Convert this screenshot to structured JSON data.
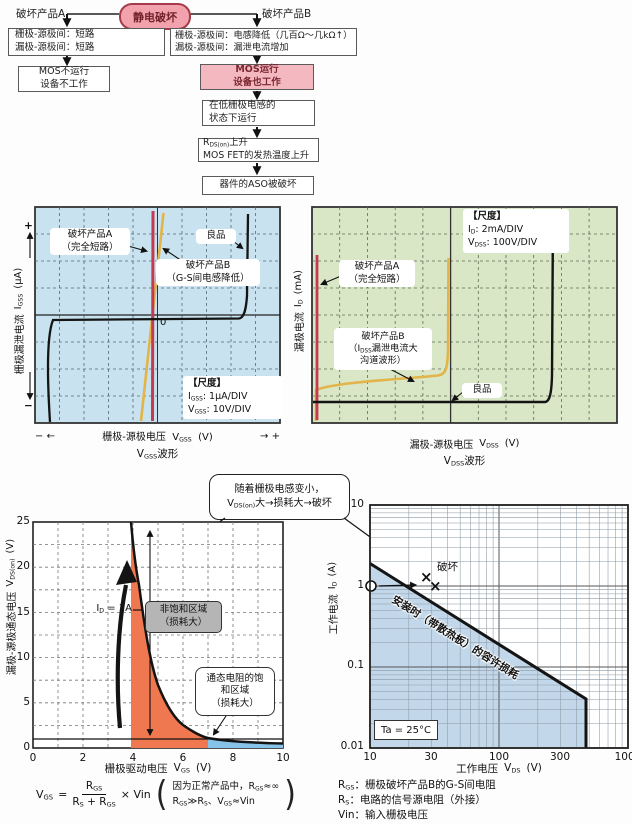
{
  "colors": {
    "osc_blue_bg": "#c9e2ef",
    "osc_green_bg": "#d9e7c6",
    "trace_red": "#c43a50",
    "trace_yellow": "#e2b44a",
    "trace_black": "#141414",
    "fill_orange": "#f07850",
    "fill_lightblue": "#85c3e8",
    "aso_fill_blue": "#c2d8ea",
    "pink_box": "#f4b9c0",
    "pink_root": "#f2a2ac"
  },
  "flow": {
    "root": "静电破坏",
    "a_title": "破坏产品A",
    "b_title": "破坏产品B",
    "a1_l1": "栅极-源极间：短路",
    "a1_l2": "漏极-源极间：短路",
    "a2_l1": "MOS不运行",
    "a2_l2": "设备不工作",
    "b1_l1": "栅极-源极间：电感降低（几百Ω～几kΩ↑）",
    "b1_l2": "漏极-源极间：漏泄电流增加",
    "b2_l1": "MOS运行",
    "b2_l2": "设备也工作",
    "b3_l1": "在低栅极电感的",
    "b3_l2": "状态下运行",
    "b4_l1_pre": "R",
    "b4_l1_sub": "DS(on)",
    "b4_l1_post": "上升",
    "b4_l2": "MOS FET的发热温度上升",
    "b5": "器件的ASO被破坏"
  },
  "gss": {
    "plus": "+",
    "minus": "−",
    "ylabel": "栅极漏泄电流",
    "ysym": "I",
    "ysub": "GSS",
    "yunit": "(μA)",
    "zero": "0",
    "labelA_l1": "破坏产品A",
    "labelA_l2": "（完全短路）",
    "labelB_l1": "破坏产品B",
    "labelB_l2": "（G-S间电感降低）",
    "good": "良品",
    "scale_title": "【尺度】",
    "s1_sym": "I",
    "s1_sub": "GSS",
    "s1_val": ": 1μA/DIV",
    "s2_sym": "V",
    "s2_sub": "GSS",
    "s2_val": ": 10V/DIV",
    "x_minus": "−",
    "x_arrow_l": "←",
    "xlabel": "栅极-源极电压",
    "xsym": "V",
    "xsub": "GSS",
    "xunit": "(V)",
    "x_arrow_r": "→",
    "x_plus": "+",
    "wave_pre": "V",
    "wave_sub": "GSS",
    "wave_post": "波形"
  },
  "dss": {
    "ylabel": "漏极电流",
    "ysym": "I",
    "ysub": "D",
    "yunit": "(mA)",
    "scale_title": "【尺度】",
    "s1_sym": "I",
    "s1_sub": "D",
    "s1_val": ": 2mA/DIV",
    "s2_sym": "V",
    "s2_sub": "DSS",
    "s2_val": ": 100V/DIV",
    "labelA_l1": "破坏产品A",
    "labelA_l2": "（完全短路）",
    "labelB_l1": "破坏产品B",
    "labelB_l2_pre": "（I",
    "labelB_l2_sub": "DSS",
    "labelB_l2_post": "漏泄电流大",
    "labelB_l3": "沟道波形）",
    "good": "良品",
    "xlabel": "漏极-源极电压",
    "xsym": "V",
    "xsub": "DSS",
    "xunit": "(V)",
    "wave_pre": "V",
    "wave_sub": "DSS",
    "wave_post": "波形"
  },
  "callout": {
    "l1": "随着栅极电感变小，",
    "l2_pre": "V",
    "l2_sub": "DS(on)",
    "l2_post": "大→损耗大→破坏"
  },
  "vgs": {
    "ylabel": "漏极-源极通态电压",
    "ysym": "V",
    "ysub": "DS(on)",
    "yunit": "(V)",
    "yticks": [
      "25",
      "20",
      "15",
      "10",
      "5",
      "0"
    ],
    "xticks": [
      "0",
      "2",
      "4",
      "6",
      "8",
      "10"
    ],
    "xlabel": "栅极驱动电压",
    "xsym": "V",
    "xsub": "GS",
    "xunit": "(V)",
    "id_pre": "I",
    "id_sub": "D",
    "id_post": " = 1A",
    "region1_l1": "非饱和区域",
    "region1_l2": "（损耗大）",
    "region2_l1": "通态电阻的饱",
    "region2_l2": "和区域",
    "region2_l3": "（损耗大）"
  },
  "aso": {
    "ylabel": "工作电流",
    "ysym": "I",
    "ysub": "D",
    "yunit": "(A)",
    "yticks": [
      "10",
      "1",
      "0.1",
      "0.01"
    ],
    "xticks": [
      "10",
      "30",
      "100",
      "300",
      "1000"
    ],
    "xlabel": "工作电压",
    "xsym": "V",
    "xsub": "DS",
    "xunit": "(V)",
    "destroy": "破坏",
    "x_mark": "×",
    "diag_label": "安装时（带散热板）的容许损耗",
    "ta": "Ta = 25°C"
  },
  "formula": {
    "lhs_sym": "V",
    "lhs_sub": "GS",
    "eq": "=",
    "num_sym": "R",
    "num_sub": "GS",
    "den1_sym": "R",
    "den1_sub": "S",
    "den_plus": " + ",
    "den2_sym": "R",
    "den2_sub": "GS",
    "times": "× Vin",
    "paren_l": "(",
    "paren_r": ")",
    "note_l1_pre": "因为正常产品中，R",
    "note_l1_sub": "GS",
    "note_l1_post": "≈∞",
    "note_l2_p1": "R",
    "note_l2_s1": "GS",
    "note_l2_p2": "≫R",
    "note_l2_s2": "S",
    "note_l2_p3": "、V",
    "note_l2_s3": "GS",
    "note_l2_p4": "≈Vin"
  },
  "defs": {
    "r1_sym": "R",
    "r1_sub": "GS",
    "r1_text": "：栅极破坏产品B的G-S间电阻",
    "r2_sym": "R",
    "r2_sub": "S",
    "r2_text": "：电路的信号源电阻（外接）",
    "r3_sym": "Vin",
    "r3_text": "：输入栅极电压"
  },
  "chart_data": [
    {
      "type": "line",
      "title": "VGSS波形 (oscilloscope)",
      "xlabel": "栅极-源极电压 VGSS (V)",
      "ylabel": "栅极漏泄电流 IGSS (μA)",
      "scale": {
        "IGSS": "1μA/DIV",
        "VGSS": "10V/DIV"
      },
      "grid": "10x8 dashed divisions",
      "series": [
        {
          "name": "破坏产品A（完全短路）",
          "shape": "vertical line through 0V (dead short)"
        },
        {
          "name": "破坏产品B（G-S间电感降低）",
          "shape": "slightly tilted line through 0V (low resistance)"
        },
        {
          "name": "良品",
          "shape": "flat ~0μA across sweep with sharp breakdown rise at both sweep ends"
        }
      ]
    },
    {
      "type": "line",
      "title": "VDSS波形 (oscilloscope)",
      "xlabel": "漏极-源极电压 VDSS (V)",
      "ylabel": "漏极电流 ID (mA)",
      "scale": {
        "ID": "2mA/DIV",
        "VDSS": "100V/DIV"
      },
      "grid": "11x8 dashed divisions",
      "series": [
        {
          "name": "破坏产品A（完全短路）",
          "shape": "vertical line at ~0V"
        },
        {
          "name": "破坏产品B（IDSS漏泄电流大，沟道波形）",
          "shape": "elevated leakage rising slowly, early breakdown rise at ~480V-div"
        },
        {
          "name": "良品",
          "shape": "flat ~0mA then sharp breakdown rise near right end (~850V-div)"
        }
      ]
    },
    {
      "type": "line",
      "title": "VDS(on) vs VGS at ID = 1A",
      "xlabel": "栅极驱动电压 VGS (V)",
      "ylabel": "漏极-源极通态电压 VDS(on) (V)",
      "xlim": [
        0,
        10
      ],
      "ylim": [
        0,
        25
      ],
      "grid": "dashed, 1V x 2.5V",
      "x": [
        3.9,
        4,
        4.25,
        4.5,
        5,
        5.5,
        6,
        6.5,
        7,
        8,
        9,
        10
      ],
      "y": [
        25,
        23.5,
        18,
        13,
        7,
        4,
        2.5,
        1.6,
        1.15,
        0.75,
        0.6,
        0.5
      ],
      "annotations": [
        "ID = 1A",
        "非饱和区域（损耗大）: orange region 3.9V-7V",
        "通态电阻的饱和区域（损耗大）: blue region 7V-10V",
        "horizontal reference line at 1V"
      ]
    },
    {
      "type": "line",
      "title": "ASO 容许损耗 (log-log)",
      "xlabel": "工作电压 VDS (V)",
      "ylabel": "工作电流 ID (A)",
      "xlim": [
        10,
        1000
      ],
      "ylim": [
        0.01,
        10
      ],
      "xticks": [
        10,
        30,
        100,
        300,
        1000
      ],
      "yticks": [
        0.01,
        0.1,
        1,
        10
      ],
      "allowed_loss_line": [
        [
          10,
          1.8
        ],
        [
          460,
          0.04
        ]
      ],
      "voltage_limit_v": 460,
      "operating_point": [
        10,
        1
      ],
      "breakdown_points": [
        [
          27,
          1.05
        ],
        [
          30,
          0.9
        ]
      ],
      "annotations": [
        "安装时（带散热板）的容许损耗",
        "破坏",
        "Ta = 25°C"
      ]
    }
  ]
}
